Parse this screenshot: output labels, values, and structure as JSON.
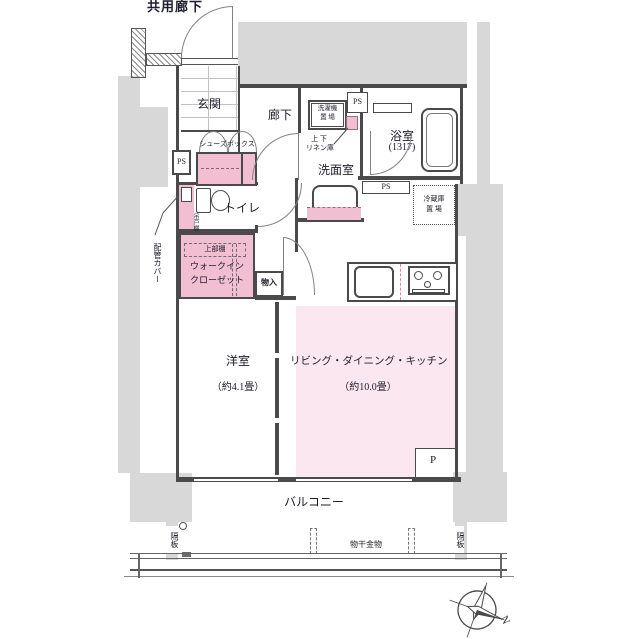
{
  "colors": {
    "structure_gray": "#d8d8d8",
    "wall_line": "#4a4a4a",
    "room_pink_light": "#fbe7ef",
    "fixture_pink": "#f2bfd2",
    "text": "#1d1d2b"
  },
  "labels": {
    "common_corridor": "共用廊下",
    "entrance": "玄関",
    "hallway": "廊下",
    "shoe_box": "シューズボックス",
    "ps": "PS",
    "washer_line1": "洗濯機",
    "washer_line2": "置 場",
    "linen_line1": "上 下",
    "linen_line2": "リネン庫",
    "washroom": "洗面室",
    "bathroom": "浴室",
    "bathroom_size": "(1317)",
    "fridge_line1": "冷蔵庫",
    "fridge_line2": "置 場",
    "toilet": "トイレ",
    "hanging_cupboard": "吊戸棚",
    "pipe_cover": "配管カバー",
    "upper_shelf": "上部棚",
    "wic_line1": "ウォークイン",
    "wic_line2": "クローゼット",
    "storage": "物入",
    "western_room": "洋室",
    "western_room_size": "（約4.1畳）",
    "ldk": "リビング・ダイニング・キッチン",
    "ldk_size": "（約10.0畳）",
    "pillar": "P",
    "balcony": "バルコニー",
    "partition_left": "隔板",
    "partition_right": "隔板",
    "laundry_hardware": "物干金物",
    "compass_north": "N"
  }
}
